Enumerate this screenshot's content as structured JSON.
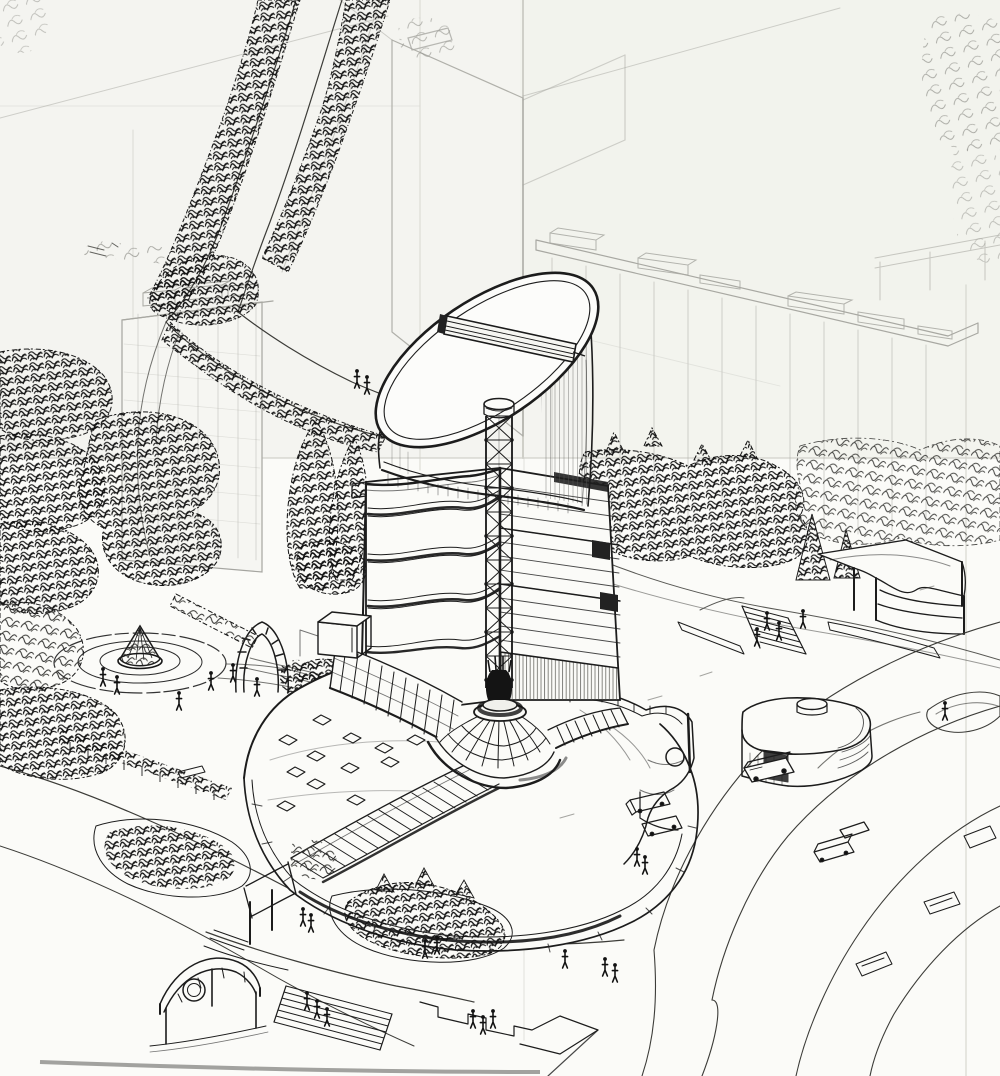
{
  "artwork": {
    "title": "Aerial perspective sketch — tower with sliced cylindrical crown, lattice mast, conical glass dome and curved podium",
    "description": "Freehand ink and graphite concept drawing on folded paper. A high-rise with a diagonally sliced cylindrical top and a rooftop louver bar rises from a low curved podium with a ribbed conical glass dome, a diagonal glazed gallery bridge, and an oval roof dotted with skylights. Around it: a park with a circular fountain plaza and pergola arch, tree-lined footpaths, faint background slab blocks, a square annex pavilion with a drum skylight, an arched entrance canopy, grand steps, sweeping roads with traffic islands, service trucks, buses and scattered pedestrians.",
    "medium": "ink and graphite on folded paper",
    "visible_text": "(none — the drawing contains no legible text)",
    "elements": [
      "background slab building with rooftop boxes",
      "left residential tower",
      "tree-lined footpath",
      "park with circular fountain plaza",
      "pergola arch",
      "main tower with wavy balcony bands",
      "sliced cylinder crown",
      "rooftop louver bar",
      "lattice mast",
      "conical ribbed glass dome",
      "glazed gallery bridge",
      "oval podium roof with skylights",
      "podium right wing with porthole window",
      "square annex pavilion with drum skylight",
      "arched entrance canopy pavilion",
      "grand steps with people",
      "curving roads and traffic islands",
      "buses and service trucks",
      "pedestrians"
    ]
  },
  "palette": {
    "paper": "#fbfbf8",
    "paper_upper": "#f4f4f0",
    "tint_green": "#eef2e9",
    "ink": "#1c1c1c",
    "ink_soft": "#3c3c38",
    "pencil": "#a8a8a2",
    "fold": "#cbcbc4"
  }
}
